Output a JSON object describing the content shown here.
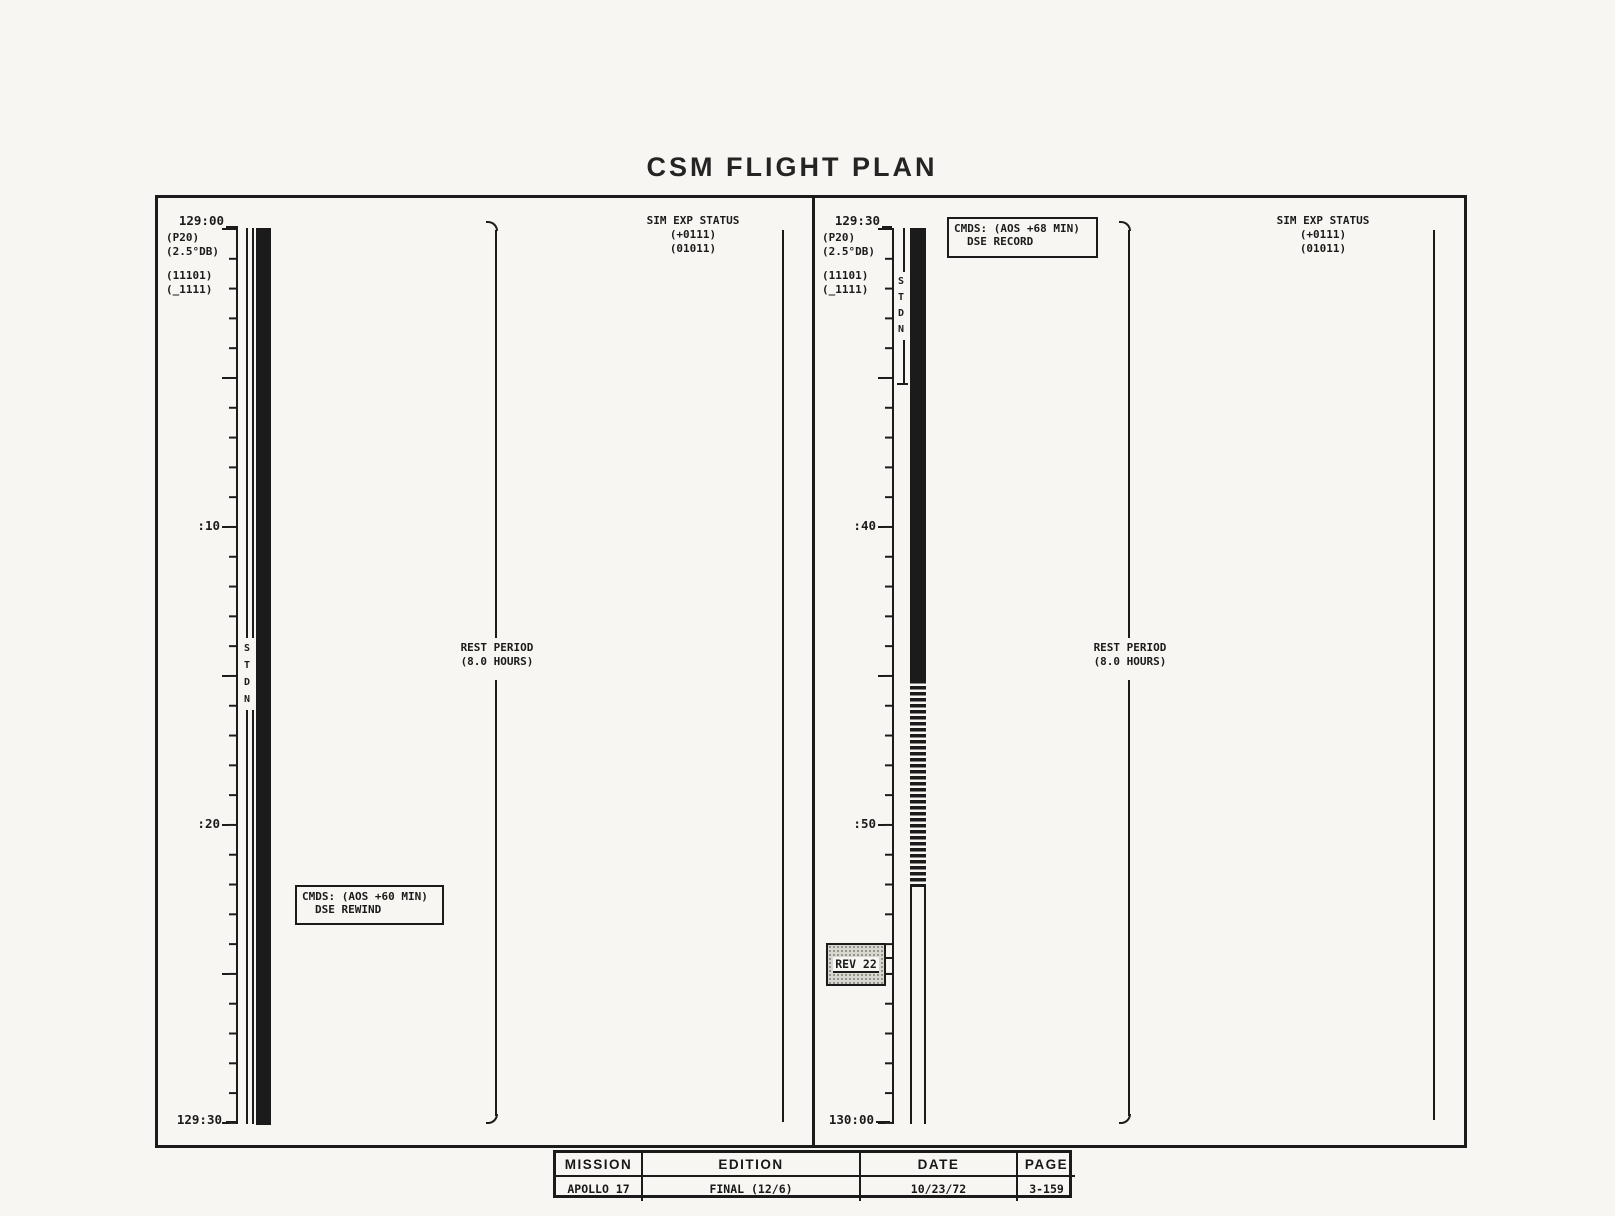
{
  "title": "CSM FLIGHT PLAN",
  "panels": [
    {
      "time_top": "129:00",
      "time_bottom": "129:30",
      "ann_p20": "(P20)",
      "ann_db": "(2.5°DB)",
      "ann_code1": "(11101)",
      "ann_code2": "(_1111)",
      "tick_label_1": ":10",
      "tick_label_2": ":20",
      "stdn": "STDN",
      "cmds_line1": "CMDS: (AOS +60 MIN)",
      "cmds_line2": "DSE REWIND",
      "rest_line1": "REST PERIOD",
      "rest_line2": "(8.0 HOURS)",
      "sim_title": "SIM EXP STATUS",
      "sim_line1": "(+0111)",
      "sim_line2": "(01011)"
    },
    {
      "time_top": "129:30",
      "time_bottom": "130:00",
      "ann_p20": "(P20)",
      "ann_db": "(2.5°DB)",
      "ann_code1": "(11101)",
      "ann_code2": "(_1111)",
      "tick_label_1": ":40",
      "tick_label_2": ":50",
      "stdn": "STDN",
      "cmds_line1": "CMDS: (AOS +68 MIN)",
      "cmds_line2": "DSE RECORD",
      "rev_badge": "REV 22",
      "rest_line1": "REST PERIOD",
      "rest_line2": "(8.0 HOURS)",
      "sim_title": "SIM EXP STATUS",
      "sim_line1": "(+0111)",
      "sim_line2": "(01011)"
    }
  ],
  "footer": {
    "headers": [
      "MISSION",
      "EDITION",
      "DATE",
      "PAGE"
    ],
    "values": [
      "APOLLO 17",
      "FINAL (12/6)",
      "10/23/72",
      "3-159"
    ]
  },
  "colors": {
    "ink": "#1b1b1b",
    "paper": "#f7f6f2"
  }
}
